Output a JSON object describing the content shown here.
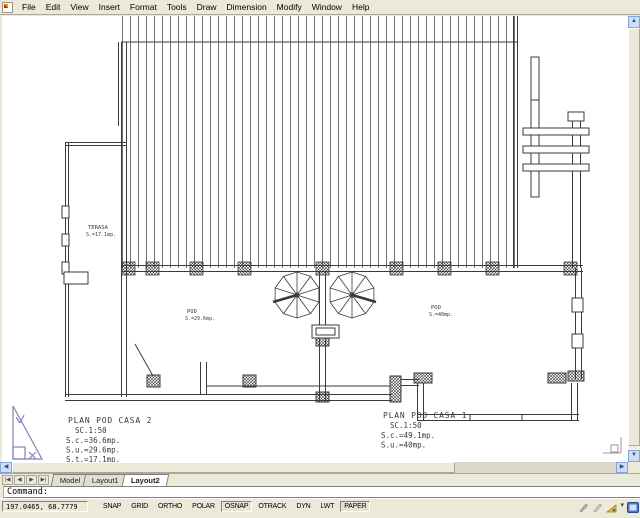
{
  "menu": {
    "app_icon": "autocad-file-icon",
    "items": [
      "File",
      "Edit",
      "View",
      "Insert",
      "Format",
      "Tools",
      "Draw",
      "Dimension",
      "Modify",
      "Window",
      "Help"
    ]
  },
  "plan": {
    "terasa": {
      "name": "TERASA",
      "area": "S.=17.1mp."
    },
    "pod_casa2": {
      "name": "POD",
      "area": "S.=29.6mp."
    },
    "pod_casa1": {
      "name": "POD",
      "area": "S.=40mp."
    },
    "title_casa2": {
      "title": "PLAN POD CASA 2",
      "scale": "SC.1:50",
      "sc": "S.c.=36.6mp.",
      "su": "S.u.=29.6mp.",
      "st": "S.t.=17.1mp."
    },
    "title_casa1": {
      "title": "PLAN POD CASA 1",
      "scale": "SC.1:50",
      "sc": "S.c.=49.1mp.",
      "su": "S.u.=40mp."
    }
  },
  "tabs": {
    "nav": [
      "|◀",
      "◀",
      "▶",
      "▶|"
    ],
    "items": [
      {
        "label": "Model",
        "active": false
      },
      {
        "label": "Layout1",
        "active": false
      },
      {
        "label": "Layout2",
        "active": true
      }
    ]
  },
  "command": {
    "prompt": "Command:"
  },
  "status": {
    "coords": "197.0465, 68.7779",
    "toggles": [
      {
        "label": "SNAP",
        "on": false
      },
      {
        "label": "GRID",
        "on": false
      },
      {
        "label": "ORTHO",
        "on": false
      },
      {
        "label": "POLAR",
        "on": false
      },
      {
        "label": "OSNAP",
        "on": true
      },
      {
        "label": "OTRACK",
        "on": false
      },
      {
        "label": "DYN",
        "on": false
      },
      {
        "label": "LWT",
        "on": false
      },
      {
        "label": "PAPER",
        "on": true
      }
    ],
    "tray_icons": [
      "annotation-icon",
      "annotation-scale-icon",
      "scale-sync-icon",
      "tray-caret-icon",
      "clean-screen-icon"
    ]
  },
  "colors": {
    "chrome": "#ece9d8",
    "canvas": "#ffffff",
    "line": "#3b3b3b",
    "paper_ucs_triangle": "#8282ba"
  }
}
